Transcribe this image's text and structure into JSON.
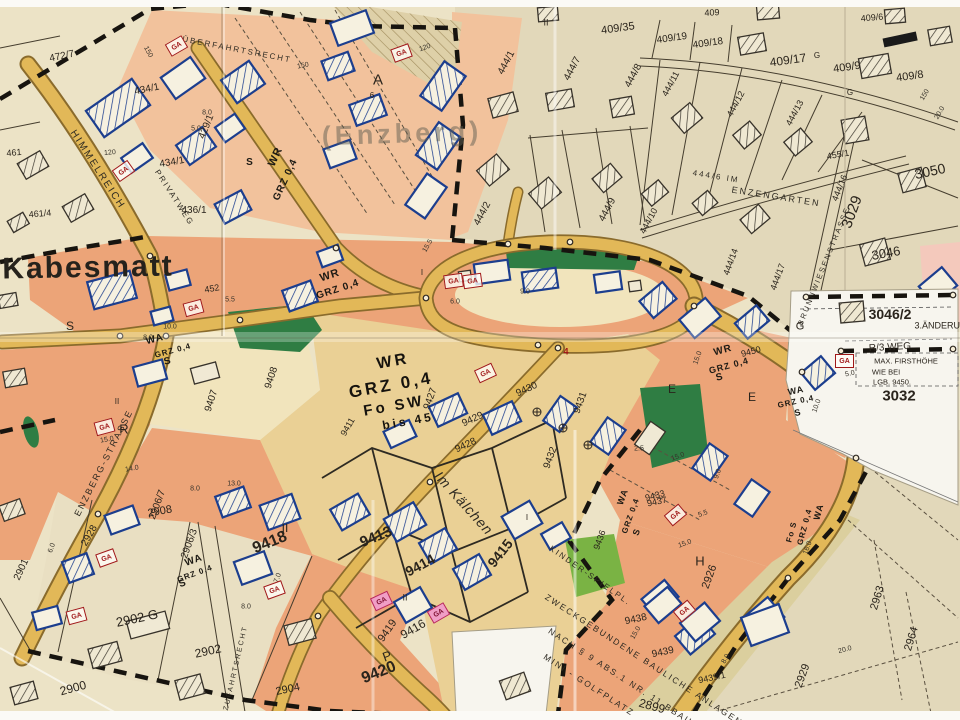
{
  "map": {
    "colors": {
      "paper": "#ece3c6",
      "beige": "#e2d8ba",
      "beige2": "#e9dfc2",
      "orange": "#eca478",
      "orange-light": "#f2c29c",
      "tan": "#ead095",
      "pale": "#f1e4bc",
      "pink": "#f4c9bc",
      "road": "#e2b858",
      "road-edge": "#8a6b2c",
      "green": "#2f7d43",
      "green-bright": "#7ab344",
      "khaki": "#dbcf9e",
      "white-patch": "#f7f5ee",
      "blue": "#1c3e8e",
      "ink": "#2a241c",
      "red": "#a01818"
    },
    "symbols": {
      "garage": "GA"
    },
    "labels": [
      [
        "Kabesmatt",
        88,
        268,
        -1,
        30,
        "big"
      ],
      [
        "(Enzberg)",
        402,
        134,
        -2,
        27,
        "faded"
      ],
      [
        "HIMMELREICH",
        97,
        170,
        57,
        10,
        "street"
      ],
      [
        "PRIVATWEG",
        174,
        198,
        57,
        8,
        "street"
      ],
      [
        "ÜBERFAHRTSRECHT",
        237,
        50,
        11,
        8,
        "street"
      ],
      [
        "ENZBERG-STRASSE",
        104,
        463,
        -63,
        9,
        "street"
      ],
      [
        "Im Kälchen",
        464,
        503,
        48,
        14,
        "street-i"
      ],
      [
        "444/6 IM",
        716,
        177,
        9,
        8,
        "street"
      ],
      [
        "ENZENGARTEN",
        776,
        197,
        9,
        9,
        "street"
      ],
      [
        "BRUNNWIESENSTRASSE",
        824,
        266,
        -68,
        7.5,
        "street"
      ],
      [
        "ZUFAHRTSRECHT",
        236,
        668,
        -77,
        7,
        "street"
      ],
      [
        "ZWECKGEBUNDENE BAULICHE ANLAGEN",
        644,
        660,
        33,
        8.5,
        "street"
      ],
      [
        "NACH § 9 ABS.1 NR. 11 BBAUG",
        624,
        679,
        33,
        8.5,
        "street"
      ],
      [
        "MINI - GOLFPLATZ",
        589,
        685,
        33,
        8.5,
        "street"
      ],
      [
        "KINDER-SPIELPL.",
        590,
        576,
        35,
        8,
        "street"
      ],
      [
        "WR",
        330,
        276,
        -18,
        11,
        "stamp"
      ],
      [
        "GRZ 0,4",
        338,
        290,
        -18,
        10,
        "stamp"
      ],
      [
        "WR",
        393,
        362,
        -10,
        16,
        "stamp2"
      ],
      [
        "GRZ 0,4",
        391,
        385,
        -10,
        17,
        "stamp2"
      ],
      [
        "Fo SW",
        394,
        406,
        -10,
        15,
        "stamp2"
      ],
      [
        "bis 45",
        408,
        421,
        -10,
        12,
        "stamp2"
      ],
      [
        "WR",
        723,
        351,
        -15,
        10,
        "stamp"
      ],
      [
        "9450",
        751,
        352,
        -15,
        9,
        "hand"
      ],
      [
        "GRZ 0,4",
        729,
        366,
        -15,
        9,
        "stamp"
      ],
      [
        "S",
        720,
        378,
        -15,
        10,
        "stamp"
      ],
      [
        "WA",
        796,
        391,
        -12,
        9,
        "stamp"
      ],
      [
        "GRZ 0,4",
        796,
        402,
        -12,
        8,
        "stamp"
      ],
      [
        "S",
        798,
        413,
        -12,
        9,
        "stamp"
      ],
      [
        "WA",
        819,
        512,
        -75,
        9,
        "stamp"
      ],
      [
        "GRZ 0,4",
        805,
        527,
        -75,
        8,
        "stamp"
      ],
      [
        "Fo S",
        792,
        532,
        -75,
        8,
        "stamp"
      ],
      [
        "WA",
        623,
        497,
        -70,
        9,
        "stamp"
      ],
      [
        "GRZ 0,4",
        631,
        516,
        -70,
        8,
        "stamp"
      ],
      [
        "S",
        637,
        532,
        -70,
        9,
        "stamp"
      ],
      [
        "WA",
        155,
        340,
        -15,
        10,
        "stamp"
      ],
      [
        "GRZ 0,4",
        173,
        351,
        -15,
        8,
        "stamp"
      ],
      [
        "S",
        168,
        362,
        -15,
        10,
        "stamp"
      ],
      [
        "WA",
        194,
        561,
        -20,
        10,
        "stamp"
      ],
      [
        "GRZ 0,4",
        195,
        574,
        -20,
        8,
        "stamp"
      ],
      [
        "S",
        183,
        584,
        -20,
        10,
        "stamp"
      ],
      [
        "WR",
        276,
        157,
        -65,
        11,
        "stamp"
      ],
      [
        "GRZ 0,4",
        286,
        180,
        -65,
        10,
        "stamp"
      ],
      [
        "S",
        250,
        163,
        0,
        10,
        "stamp"
      ],
      [
        "S",
        70,
        326,
        0,
        12,
        "hand"
      ],
      [
        "R",
        124,
        429,
        0,
        13,
        "hand"
      ],
      [
        "P",
        387,
        656,
        -20,
        13,
        "hand"
      ],
      [
        "A",
        378,
        80,
        0,
        15,
        "hand"
      ],
      [
        "H",
        700,
        561,
        0,
        13,
        "hand"
      ],
      [
        "E",
        672,
        389,
        0,
        12,
        "hand"
      ],
      [
        "E",
        752,
        397,
        0,
        12,
        "hand"
      ],
      [
        "G",
        800,
        327,
        0,
        11,
        "hand"
      ],
      [
        "G",
        817,
        56,
        0,
        8,
        "hand"
      ],
      [
        "G",
        850,
        93,
        0,
        8,
        "hand"
      ],
      [
        "II",
        117,
        402,
        0,
        8,
        "hand"
      ],
      [
        "II",
        546,
        23,
        0,
        9,
        "hand"
      ],
      [
        "II",
        405,
        598,
        0,
        9,
        "hand"
      ],
      [
        "II",
        285,
        528,
        0,
        12,
        "hand"
      ],
      [
        "I",
        422,
        273,
        0,
        8,
        "hand"
      ],
      [
        "I",
        527,
        518,
        0,
        8,
        "hand"
      ],
      [
        "472/7",
        62,
        57,
        -12,
        10,
        "hand"
      ],
      [
        "461",
        14,
        153,
        -5,
        9,
        "hand"
      ],
      [
        "461/4",
        40,
        214,
        -5,
        9,
        "hand"
      ],
      [
        "434/1",
        147,
        90,
        -12,
        10,
        "hand"
      ],
      [
        "434/1",
        172,
        163,
        -10,
        10,
        "hand"
      ],
      [
        "429/1",
        207,
        127,
        -68,
        10,
        "hand"
      ],
      [
        "436/1",
        194,
        211,
        0,
        10,
        "hand"
      ],
      [
        "444/1",
        507,
        63,
        -62,
        10,
        "hand"
      ],
      [
        "444/7",
        573,
        69,
        -62,
        10,
        "hand"
      ],
      [
        "444/8",
        634,
        76,
        -62,
        10,
        "hand"
      ],
      [
        "444/2",
        483,
        214,
        -62,
        10,
        "hand"
      ],
      [
        "444/9",
        608,
        210,
        -62,
        10,
        "hand"
      ],
      [
        "444/10",
        649,
        221,
        -62,
        9,
        "hand"
      ],
      [
        "444/11",
        671,
        84,
        -62,
        9,
        "hand"
      ],
      [
        "444/12",
        736,
        104,
        -62,
        9,
        "hand"
      ],
      [
        "444/13",
        795,
        113,
        -62,
        9,
        "hand"
      ],
      [
        "409/35",
        618,
        29,
        -8,
        11,
        "hand"
      ],
      [
        "409/19",
        672,
        39,
        -8,
        10,
        "hand"
      ],
      [
        "409/18",
        708,
        44,
        -8,
        10,
        "hand"
      ],
      [
        "409/17",
        788,
        60,
        -8,
        12,
        "hand"
      ],
      [
        "409/9",
        847,
        68,
        -8,
        11,
        "hand"
      ],
      [
        "409/8",
        910,
        77,
        -8,
        11,
        "hand"
      ],
      [
        "409/6",
        872,
        18,
        -5,
        9,
        "hand"
      ],
      [
        "409",
        712,
        13,
        -3,
        9,
        "hand"
      ],
      [
        "455/1",
        838,
        155,
        -10,
        9,
        "hand"
      ],
      [
        "444/16",
        840,
        188,
        -68,
        9,
        "hand"
      ],
      [
        "3050",
        930,
        171,
        -12,
        14,
        "hand"
      ],
      [
        "3029",
        852,
        212,
        -70,
        15,
        "hand"
      ],
      [
        "3046",
        886,
        253,
        -10,
        13,
        "hand"
      ],
      [
        "3046/2",
        890,
        314,
        0,
        14,
        "hand-b"
      ],
      [
        "3.ÄNDERUNG",
        944,
        326,
        0,
        9,
        "hand"
      ],
      [
        "R/3 WEG",
        890,
        348,
        -3,
        10,
        "hand"
      ],
      [
        "MAX. FIRSTHÖHE",
        906,
        361,
        0,
        7.5,
        "hand"
      ],
      [
        "WIE BEI",
        886,
        372,
        0,
        7.5,
        "hand"
      ],
      [
        "LGB. 9450.",
        892,
        382,
        0,
        7.5,
        "hand"
      ],
      [
        "3032",
        899,
        396,
        0,
        15,
        "hand-b"
      ],
      [
        "444/14",
        731,
        262,
        -70,
        9,
        "hand"
      ],
      [
        "444/17",
        778,
        277,
        -70,
        9,
        "hand"
      ],
      [
        "9407",
        212,
        401,
        -72,
        10,
        "hand"
      ],
      [
        "9408",
        272,
        378,
        -72,
        10,
        "hand"
      ],
      [
        "9427",
        431,
        399,
        -70,
        10,
        "hand"
      ],
      [
        "9430",
        527,
        390,
        -25,
        10,
        "hand"
      ],
      [
        "9431",
        581,
        403,
        -70,
        10,
        "hand"
      ],
      [
        "9429",
        473,
        420,
        -25,
        10,
        "hand"
      ],
      [
        "9428",
        466,
        446,
        -25,
        10,
        "hand"
      ],
      [
        "9432",
        551,
        458,
        -70,
        10,
        "hand"
      ],
      [
        "9433",
        655,
        496,
        -15,
        9,
        "hand"
      ],
      [
        "9436",
        600,
        540,
        -70,
        9,
        "hand"
      ],
      [
        "9437",
        657,
        502,
        -12,
        9,
        "hand"
      ],
      [
        "9438",
        636,
        620,
        -12,
        10,
        "hand"
      ],
      [
        "9439",
        663,
        653,
        -12,
        10,
        "hand"
      ],
      [
        "9439/1",
        712,
        678,
        -12,
        9,
        "hand"
      ],
      [
        "9411",
        348,
        427,
        -60,
        9,
        "hand"
      ],
      [
        "9413",
        376,
        537,
        -22,
        15,
        "hand-b"
      ],
      [
        "9414",
        420,
        565,
        -28,
        14,
        "hand-b"
      ],
      [
        "9415",
        500,
        553,
        -52,
        14,
        "hand-b"
      ],
      [
        "9416",
        413,
        629,
        -30,
        12,
        "hand"
      ],
      [
        "9419",
        388,
        631,
        -55,
        11,
        "hand"
      ],
      [
        "9420",
        379,
        673,
        -22,
        16,
        "hand-b"
      ],
      [
        "9418",
        270,
        543,
        -22,
        16,
        "hand-b"
      ],
      [
        "2908",
        160,
        512,
        -10,
        11,
        "hand"
      ],
      [
        "2906/3",
        190,
        544,
        -70,
        10,
        "hand"
      ],
      [
        "2906/7",
        158,
        505,
        -70,
        10,
        "hand"
      ],
      [
        "2928",
        90,
        536,
        -60,
        10,
        "hand"
      ],
      [
        "2902 G",
        137,
        618,
        -12,
        13,
        "hand"
      ],
      [
        "2902",
        208,
        651,
        -12,
        12,
        "hand"
      ],
      [
        "2900",
        73,
        688,
        -15,
        12,
        "hand"
      ],
      [
        "2904",
        288,
        690,
        -12,
        11,
        "hand"
      ],
      [
        "2901",
        22,
        570,
        -65,
        10,
        "hand"
      ],
      [
        "452",
        212,
        289,
        -10,
        9,
        "hand"
      ],
      [
        "2926",
        710,
        577,
        -70,
        11,
        "hand"
      ],
      [
        "2929",
        803,
        676,
        -70,
        11,
        "hand"
      ],
      [
        "2963",
        878,
        598,
        -73,
        11,
        "hand"
      ],
      [
        "2964",
        912,
        639,
        -73,
        11,
        "hand"
      ],
      [
        "2899",
        652,
        706,
        15,
        12,
        "hand"
      ],
      [
        "4",
        566,
        352,
        0,
        9,
        "red"
      ],
      [
        "6",
        372,
        96,
        0,
        8,
        "hand"
      ],
      [
        "150",
        148,
        52,
        62,
        7,
        "meas"
      ],
      [
        "150",
        303,
        66,
        -12,
        7,
        "meas"
      ],
      [
        "120",
        110,
        153,
        -5,
        7,
        "meas"
      ],
      [
        "120",
        425,
        48,
        -20,
        7,
        "meas"
      ],
      [
        "8.0",
        207,
        113,
        0,
        7,
        "meas"
      ],
      [
        "5.0",
        196,
        129,
        0,
        7,
        "meas"
      ],
      [
        "8.0",
        148,
        338,
        0,
        7,
        "meas"
      ],
      [
        "10.0",
        170,
        327,
        0,
        7,
        "meas"
      ],
      [
        "5.5",
        230,
        300,
        0,
        7,
        "meas"
      ],
      [
        "15.0",
        107,
        440,
        -10,
        7,
        "meas"
      ],
      [
        "14.0",
        132,
        469,
        -10,
        7,
        "meas"
      ],
      [
        "9.0",
        525,
        292,
        0,
        7,
        "meas"
      ],
      [
        "6.0",
        455,
        302,
        0,
        7,
        "meas"
      ],
      [
        "15.5",
        428,
        246,
        -60,
        7,
        "meas"
      ],
      [
        "15.0",
        698,
        358,
        -70,
        7,
        "meas"
      ],
      [
        "10.0",
        817,
        406,
        -70,
        7,
        "meas"
      ],
      [
        "5.0",
        850,
        374,
        -12,
        7,
        "meas"
      ],
      [
        "16.0",
        808,
        548,
        -70,
        7,
        "meas"
      ],
      [
        "8.0",
        195,
        489,
        0,
        7,
        "meas"
      ],
      [
        "13.0",
        234,
        484,
        0,
        7,
        "meas"
      ],
      [
        "6.0",
        52,
        548,
        -70,
        7,
        "meas"
      ],
      [
        "8.0",
        246,
        607,
        0,
        7,
        "meas"
      ],
      [
        "7.0",
        278,
        578,
        -70,
        7,
        "meas"
      ],
      [
        "20.0",
        845,
        650,
        -15,
        7,
        "meas"
      ],
      [
        "5.5",
        703,
        514,
        -20,
        7,
        "meas"
      ],
      [
        "15.0",
        685,
        544,
        -20,
        7,
        "meas"
      ],
      [
        "15.0",
        636,
        633,
        -60,
        7,
        "meas"
      ],
      [
        "8.0",
        726,
        659,
        -60,
        7,
        "meas"
      ],
      [
        "2.5",
        639,
        449,
        0,
        7,
        "meas"
      ],
      [
        "9.0",
        718,
        474,
        -70,
        7,
        "meas"
      ],
      [
        "15.0",
        678,
        457,
        -20,
        7,
        "meas"
      ],
      [
        "20.0",
        940,
        113,
        -60,
        7,
        "meas"
      ],
      [
        "150",
        925,
        95,
        -60,
        7,
        "meas"
      ]
    ],
    "ga_markers": [
      [
        175,
        45,
        -30,
        0
      ],
      [
        122,
        170,
        -35,
        0
      ],
      [
        400,
        52,
        -20,
        0
      ],
      [
        192,
        307,
        -15,
        0
      ],
      [
        452,
        280,
        -8,
        0
      ],
      [
        471,
        280,
        -8,
        0
      ],
      [
        843,
        360,
        0,
        0
      ],
      [
        105,
        557,
        -20,
        0
      ],
      [
        75,
        615,
        -15,
        0
      ],
      [
        273,
        589,
        -20,
        0
      ],
      [
        683,
        610,
        -40,
        0
      ],
      [
        103,
        426,
        -15,
        0
      ],
      [
        484,
        372,
        -25,
        0
      ],
      [
        674,
        514,
        -40,
        0
      ],
      [
        380,
        600,
        -25,
        1
      ],
      [
        437,
        612,
        -30,
        1
      ]
    ]
  }
}
